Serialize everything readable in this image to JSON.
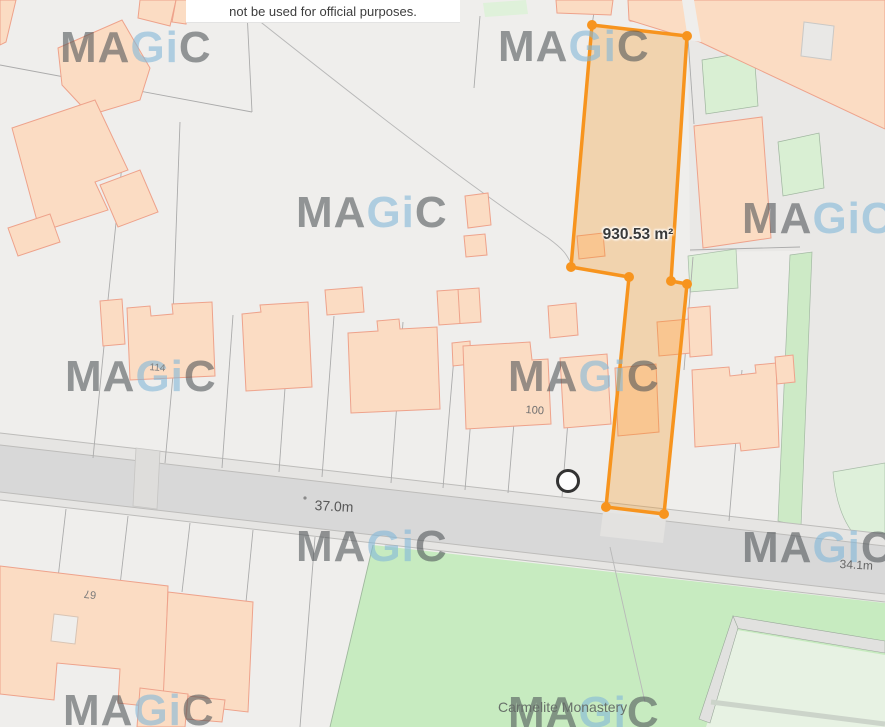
{
  "disclaimer": {
    "text": "not be used for official purposes."
  },
  "watermark": {
    "ma": "MA",
    "gi": "Gi",
    "c": "C"
  },
  "selection": {
    "area_label": "930.53 m²",
    "outline_color": "#F7941E",
    "fill_color": "rgba(244,148,30,0.30)"
  },
  "labels": {
    "road_width_main": "37.0m",
    "road_width_right": "34.1m",
    "house_114": "114",
    "house_100": "100",
    "house_67": "67",
    "monastery": "Carmelite Monastery"
  },
  "colors": {
    "background_parcel": "#EFEEEC",
    "building_fill": "#FBDCC3",
    "building_outline": "#EEA28B",
    "road_fill": "#D8D8D8",
    "green_area": "#C7EBC0",
    "pale_green_parcel": "#D9EFD3",
    "watermark_gray": "#8A8D90",
    "watermark_blue": "#BFD9EA"
  }
}
